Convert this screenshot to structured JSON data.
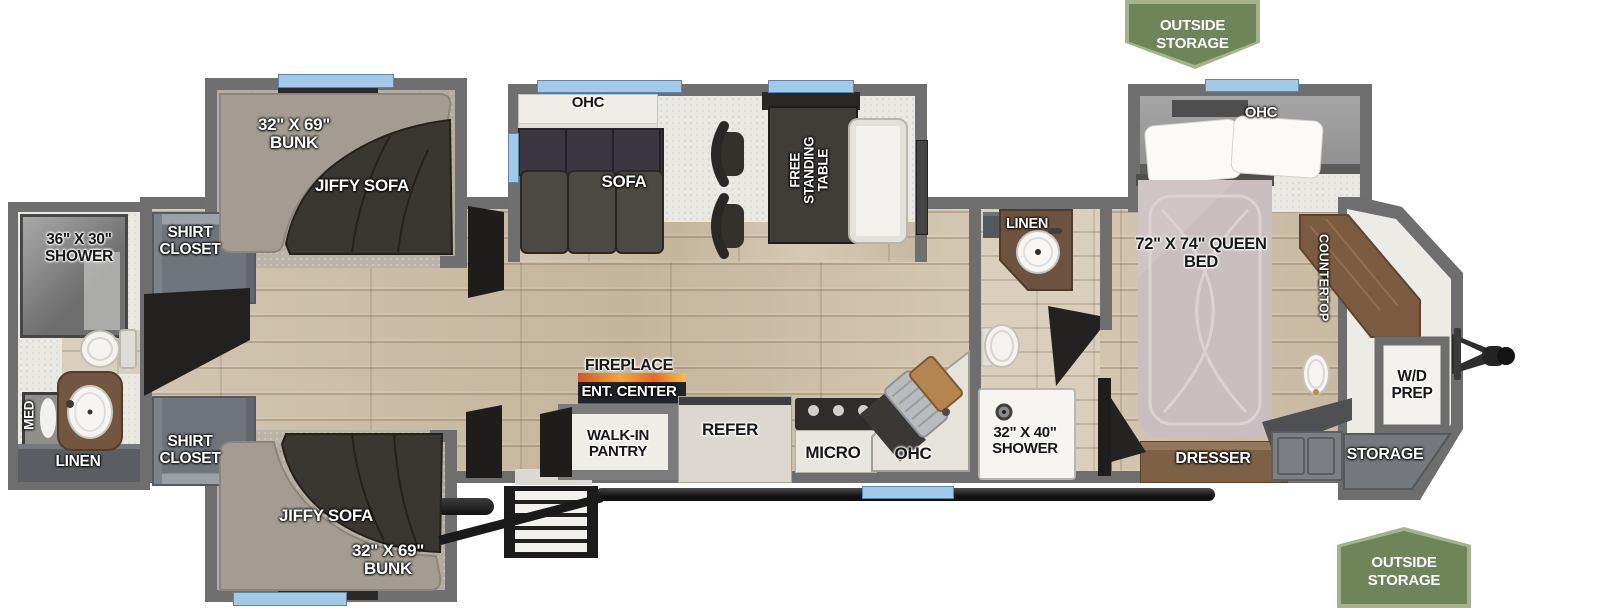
{
  "banners": {
    "top": "OUTSIDE STORAGE",
    "bottom": "OUTSIDE STORAGE"
  },
  "bunk_room_top": {
    "bunk": "32\" X 69\" BUNK",
    "sofa": "JIFFY SOFA"
  },
  "bunk_room_bottom": {
    "sofa": "JIFFY SOFA",
    "bunk": "32\" X 69\" BUNK"
  },
  "rear_bath": {
    "shower": "36\" X 30\" SHOWER",
    "med": "MED",
    "linen": "LINEN"
  },
  "closets": {
    "top": "SHIRT CLOSET",
    "bottom": "SHIRT CLOSET"
  },
  "living": {
    "ohc": "OHC",
    "sofa": "SOFA",
    "table": "FREE STANDING TABLE",
    "fireplace": "FIREPLACE",
    "ent_center": "ENT. CENTER"
  },
  "kitchen": {
    "pantry": "WALK-IN PANTRY",
    "refrigerator": "REFER",
    "microwave": "MICRO",
    "ohc": "OHC"
  },
  "mid_bath": {
    "linen": "LINEN",
    "shower": "32\" X 40\" SHOWER"
  },
  "bedroom": {
    "ohc": "OHC",
    "bed": "72\" X 74\" QUEEN BED",
    "countertop": "COUNTERTOP",
    "dresser": "DRESSER"
  },
  "front": {
    "wd_prep": "W/D PREP",
    "storage": "STORAGE"
  },
  "colors": {
    "banner_green": "#6d8559",
    "window_blue": "#a3c9e8",
    "wall_gray": "#6e6e6e",
    "wood_floor": "#cdc0ab",
    "accent_dark": "#232120"
  }
}
